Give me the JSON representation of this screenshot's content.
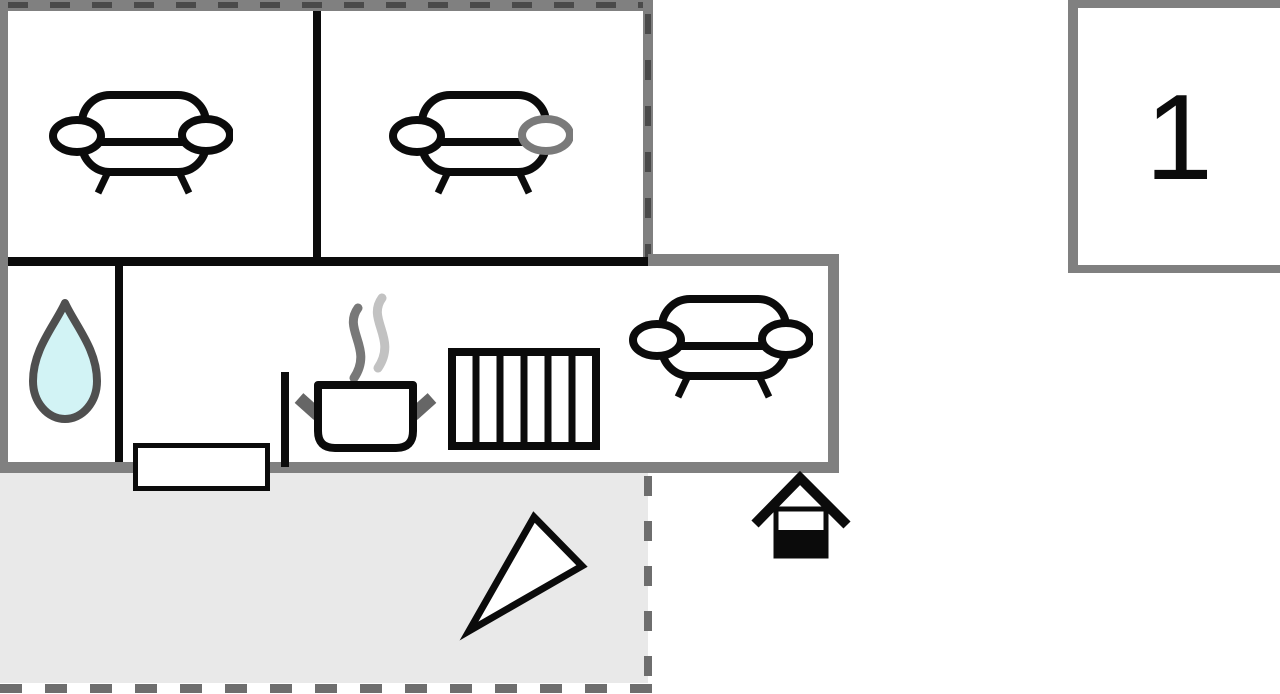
{
  "unit": {
    "label": "1"
  },
  "colors": {
    "wall_gray": "#808080",
    "wall_black": "#0b0b0b",
    "wall_dash_dark": "#4a4a4a",
    "terrace_fill": "#e9e9e9",
    "terrace_dash": "#6e6e6e",
    "water_drop_fill": "#d2f3f5",
    "water_drop_outline": "#4f4f4f",
    "steam_dark": "#787878",
    "steam_light": "#c2c2c2",
    "pot_handle_gray": "#666666",
    "sofa_armrest_gray": "#7a7a7a"
  },
  "icons": [
    "sofa-icon",
    "water-drop-icon",
    "steam-icon",
    "cooking-pot-icon",
    "radiator-icon",
    "north-arrow-icon",
    "entrance-icon"
  ]
}
